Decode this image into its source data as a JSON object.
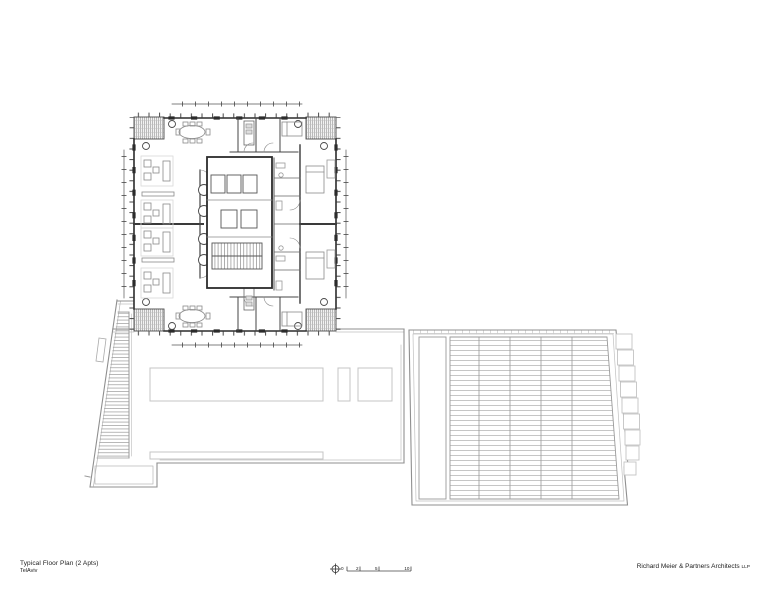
{
  "title_block": {
    "title": "Typical Floor Plan (2 Apts)",
    "subtitle": "TelAviv"
  },
  "firm": {
    "name": "Richard Meier & Partners Architects",
    "suffix": "LLP"
  },
  "scale_bar": {
    "labels": [
      "0",
      "2",
      "5",
      "10"
    ]
  },
  "icons": {
    "north_symbol": "crosshair-circle"
  },
  "colors": {
    "paper": "#ffffff",
    "ink": "#2b2b2b",
    "medium_line": "#666666",
    "light_line": "#9a9a9a",
    "faint_line": "#c4c4c4"
  }
}
